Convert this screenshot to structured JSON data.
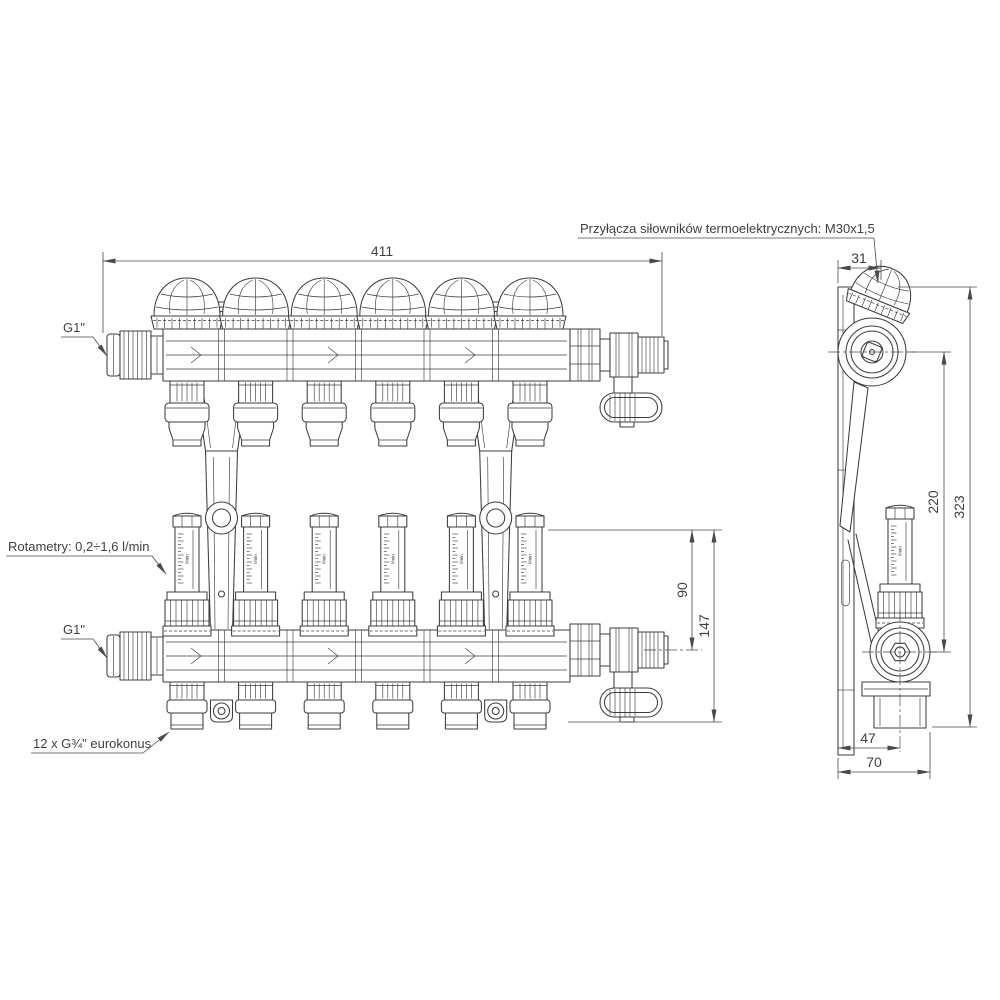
{
  "drawing": {
    "type": "technical-dimension-drawing",
    "views": [
      "front",
      "side"
    ],
    "circuits": 6
  },
  "labels": {
    "actuator_connections": "Przyłącza siłowników termoelektrycznych: M30x1,5",
    "inlet_top": "G1\"",
    "inlet_bottom": "G1\"",
    "flow_meters": "Rotametry: 0,2÷1,6 l/min",
    "outlets": "12 x G¾\" eurokonus",
    "flow_scale_unit": "l/min"
  },
  "dimensions": {
    "overall_width": "411",
    "actuator_offset": "31",
    "overall_height": "323",
    "valve_axis_spacing": "220",
    "meter_to_axis": "90",
    "meter_to_bottom": "147",
    "depth_to_axis": "47",
    "overall_depth": "70"
  },
  "colors": {
    "background": "#ffffff",
    "line": "#3d3d3d",
    "dimension": "#4a4a4a"
  }
}
